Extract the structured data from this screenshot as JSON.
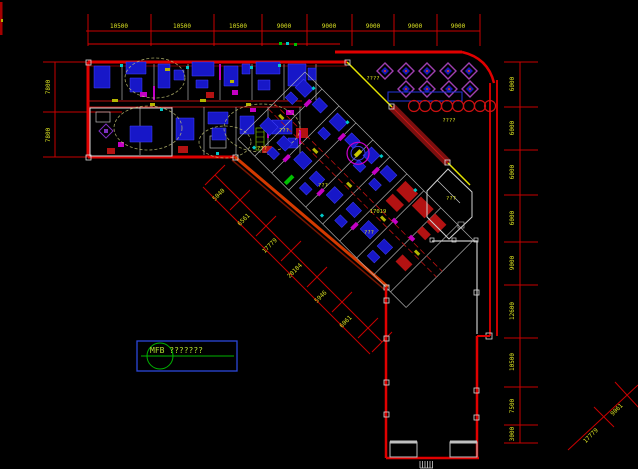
{
  "canvas": {
    "width": 638,
    "height": 469
  },
  "colors": {
    "background": "#000000",
    "dimension_line": "#c80000",
    "dimension_text": "#d9e021",
    "wall_red": "#e00000",
    "wall_white": "#c8c8c8",
    "furniture_blue": "#1717c8",
    "accent_magenta": "#c400c4",
    "accent_cyan": "#00c8c8",
    "accent_green": "#00c000",
    "plaza_yellow": "#e6e600",
    "annotation_blue": "#2b46d9",
    "annotation_green": "#00b400"
  },
  "dimensions": {
    "top": {
      "values": [
        "10500",
        "10500",
        "10500",
        "9000",
        "9000",
        "9000",
        "9000",
        "9000"
      ]
    },
    "left": {
      "values": [
        "7800",
        "7800"
      ]
    },
    "right": {
      "values": [
        "6000",
        "6000",
        "6000",
        "6000",
        "9000",
        "12600",
        "10500",
        "7500",
        "3000"
      ]
    },
    "diagonal": {
      "values": [
        "5040",
        "6561",
        "17779",
        "20184",
        "5946",
        "6061"
      ]
    },
    "corner": {
      "values": [
        "17779",
        "9061"
      ]
    }
  },
  "labels": {
    "mfb": "MFB ???????",
    "plaza": [
      "????",
      "????"
    ],
    "rooms": [
      "???",
      "???",
      "17019",
      "???",
      "???",
      "???"
    ]
  }
}
